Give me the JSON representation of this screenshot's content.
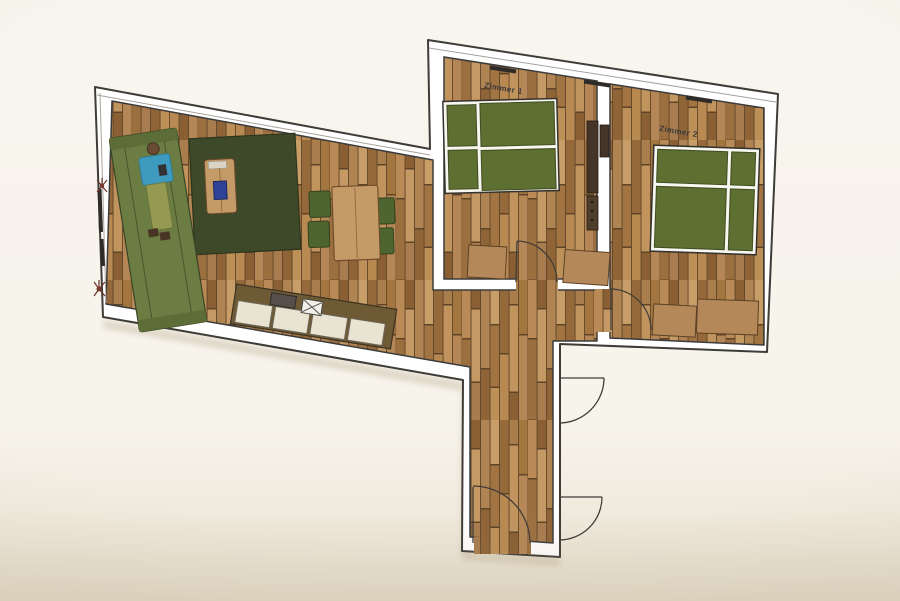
{
  "labels": {
    "zimmer1": "Zimmer 1",
    "zimmer2": "Zimmer 2"
  },
  "colors": {
    "background_top": "#f8f5ee",
    "background_bottom": "#e9e1d0",
    "wall_fill": "#ffffff",
    "outline": "#3f3c38",
    "label_text": "#3a3a3a",
    "wood_gap": "#5f4428",
    "wood_tones": [
      "#c79e68",
      "#c1945e",
      "#bd9057",
      "#b98a55",
      "#b58756",
      "#b08352",
      "#a87c4e",
      "#a3763f",
      "#9c6f3e",
      "#96693a",
      "#8f6437",
      "#8a5f33"
    ],
    "bed_green": "#5d7031",
    "sofa_green": "#6b7d42",
    "chair_green": "#4f6530",
    "rug_green": "#3e4929",
    "table_wood": "#c49a66",
    "bench_wood": "#b5885a",
    "counter_brown": "#6e5b35",
    "cabinet_cream": "#e9e3d2",
    "sink_gray": "#55504a",
    "stove_white": "#f2efe6",
    "wardrobe_brown": "#453528",
    "person_skin": "#6b4a33",
    "person_shirt": "#3e9bbf",
    "person_pants": "#949a52",
    "shoe_brown": "#4a3426",
    "plant_red": "#7a3b2e",
    "book_blue": "#2e4396"
  }
}
